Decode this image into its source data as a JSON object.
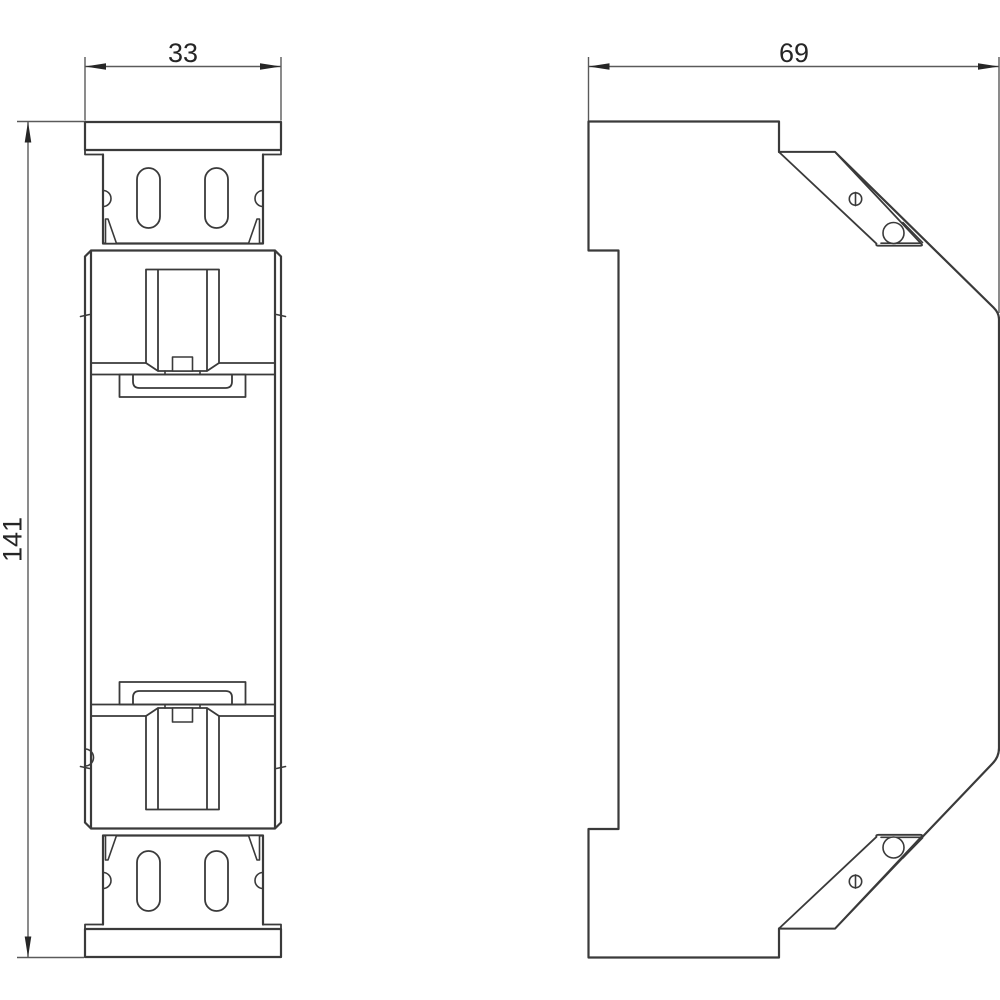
{
  "drawing": {
    "colors": {
      "outline": "#3a3a3a",
      "dimension": "#5a5a5a",
      "text": "#262626",
      "background": "#ffffff"
    },
    "front_view": {
      "width_dim": "33",
      "height_dim": "141"
    },
    "side_view": {
      "depth_dim": "69"
    }
  }
}
